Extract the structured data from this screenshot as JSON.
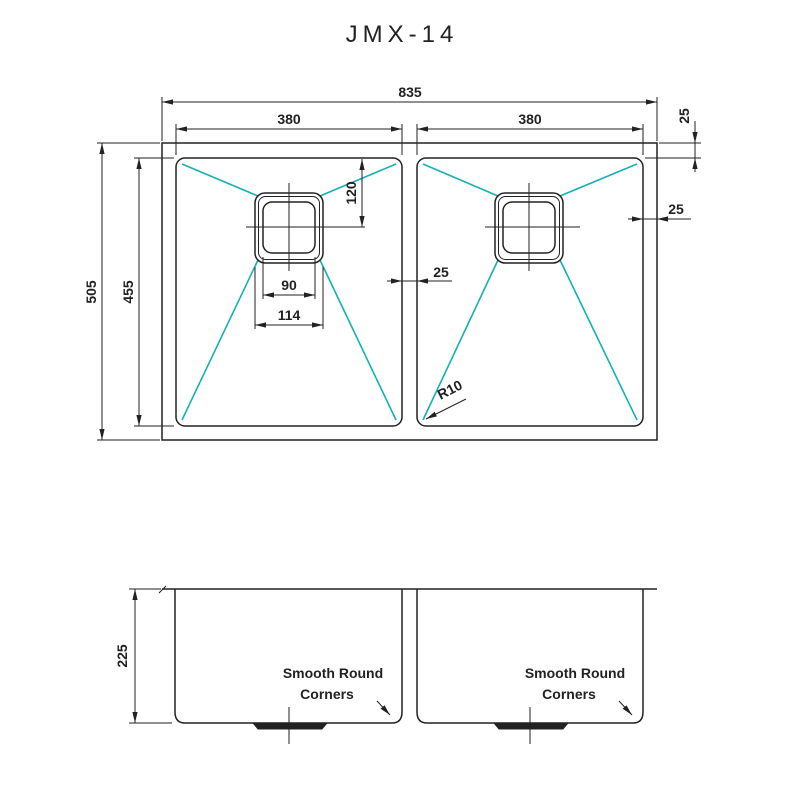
{
  "title": "JMX-14",
  "colors": {
    "line": "#222222",
    "teal": "#14b1b4"
  },
  "top_view": {
    "dim_overall_width": "835",
    "dim_bowl_width_left": "380",
    "dim_bowl_width_right": "380",
    "dim_overall_depth": "505",
    "dim_bowl_depth": "455",
    "dim_rim_top": "25",
    "dim_rim_right": "25",
    "dim_divider": "25",
    "dim_drain_to_top": "120",
    "dim_drain_inner_width": "90",
    "dim_drain_outer_width": "114",
    "dim_corner_radius": "R10"
  },
  "front_view": {
    "dim_height": "225",
    "label_line1": "Smooth Round",
    "label_line2": "Corners"
  }
}
